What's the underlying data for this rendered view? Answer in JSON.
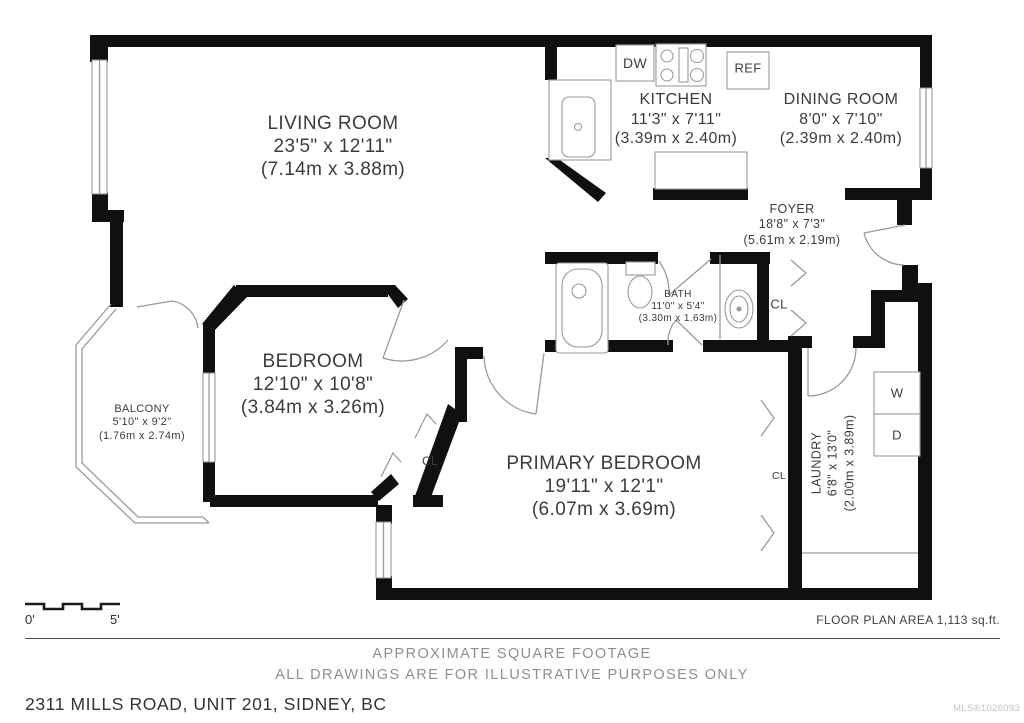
{
  "rooms": {
    "living_room": {
      "name": "LIVING ROOM",
      "imperial": "23'5\" x 12'11\"",
      "metric": "(7.14m x 3.88m)"
    },
    "kitchen": {
      "name": "KITCHEN",
      "imperial": "11'3\" x 7'11\"",
      "metric": "(3.39m x 2.40m)"
    },
    "dining_room": {
      "name": "DINING ROOM",
      "imperial": "8'0\" x 7'10\"",
      "metric": "(2.39m x 2.40m)"
    },
    "foyer": {
      "name": "FOYER",
      "imperial": "18'8\" x 7'3\"",
      "metric": "(5.61m x 2.19m)"
    },
    "bath": {
      "name": "BATH",
      "imperial": "11'0\" x 5'4\"",
      "metric": "(3.30m x 1.63m)"
    },
    "bedroom": {
      "name": "BEDROOM",
      "imperial": "12'10\" x 10'8\"",
      "metric": "(3.84m x 3.26m)"
    },
    "balcony": {
      "name": "BALCONY",
      "imperial": "5'10\" x 9'2\"",
      "metric": "(1.76m x 2.74m)"
    },
    "primary_bedroom": {
      "name": "PRIMARY BEDROOM",
      "imperial": "19'11\" x 12'1\"",
      "metric": "(6.07m x 3.69m)"
    },
    "laundry": {
      "name": "LAUNDRY",
      "imperial": "6'8\" x 13'0\"",
      "metric": "(2.00m x 3.89m)"
    }
  },
  "labels": {
    "dishwasher": "DW",
    "refrigerator": "REF",
    "washer": "W",
    "dryer": "D",
    "closet": "CL"
  },
  "scale_bar": {
    "start": "0'",
    "end": "5'"
  },
  "footer": {
    "area": "FLOOR PLAN AREA 1,113 sq.ft.",
    "note1": "APPROXIMATE SQUARE FOOTAGE",
    "note2": "ALL DRAWINGS ARE FOR ILLUSTRATIVE PURPOSES ONLY",
    "address": "2311 MILLS ROAD, UNIT 201, SIDNEY, BC",
    "watermark": "MLS®1028093"
  },
  "colors": {
    "wall": "#101010",
    "text": "#3c3c3c",
    "muted": "#8f8f8f",
    "thin_line": "#9a9a9a"
  }
}
